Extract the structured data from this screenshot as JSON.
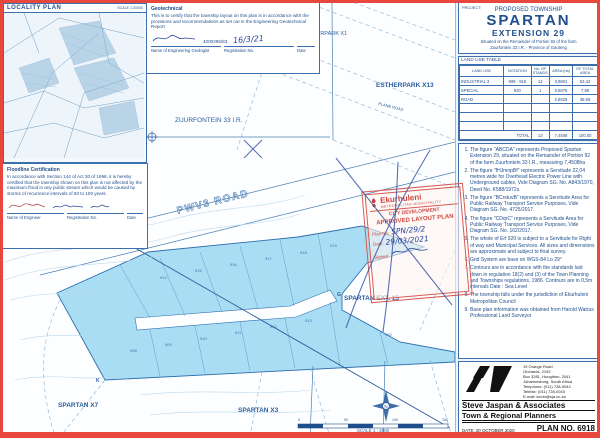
{
  "locality": {
    "title": "LOCALITY PLAN",
    "scale": "SCALE 1:20000"
  },
  "geotechnical": {
    "title": "Geotechnical",
    "body": "This is to certify that the township layout on this plan is in accordance with the provisions and recommendations as set out in the Engineering Geotechnical Report",
    "registration_no": "4000295/83",
    "date_handwritten": "16/3/21",
    "labels": {
      "name": "Name of Engineering Geologist",
      "registration": "Registration No.",
      "date": "Date"
    }
  },
  "floodline": {
    "title": "Floodline Certification",
    "body": "In accordance with Section 144 of Act 30 of 1998, it is hereby certified that the township shown on this plan is not affected by the maximum flood in any public stream which would be caused by storms of recurrence intervals of 50 to 100 years.",
    "labels": {
      "name": "Name of Engineer",
      "registration": "Registration No.",
      "date": "Date"
    }
  },
  "map": {
    "labels": {
      "estherpark_x1": "ESTHERPARK X1",
      "estherpark_x13": "ESTHERPARK X13",
      "zuurfontein": "ZUURFONTEIN 33 I.R.",
      "pwv3": "PWV3 ROAD",
      "plane_road": "PLANE ROAD",
      "spartan_ext15": "SPARTAN EXT. 15",
      "spartan_x7": "SPARTAN X7",
      "spartan_x3": "SPARTAN X3",
      "point_g": "G",
      "point_k": "K",
      "scale": "SCALE 1 : 2000",
      "scale_ticks": [
        "0",
        "50",
        "100",
        "150"
      ]
    },
    "stands": [
      "908",
      "909",
      "910",
      "911",
      "912",
      "913",
      "914",
      "915",
      "916",
      "917",
      "918",
      "919",
      "920"
    ]
  },
  "stamp": {
    "municipality": "Ekurhuleni",
    "subtitle": "METROPOLITAN MUNICIPALITY",
    "dept": "CITY DEVELOPMENT",
    "approved": "APPROVED LAYOUT PLAN",
    "plan_no_label": "Plan No:",
    "plan_no_value": "SPN/29/2",
    "date_label": "Date:",
    "date_value": "29/03/2021",
    "signed_label": "Signed"
  },
  "title_block": {
    "project_label": "PROJECT:",
    "line1": "PROPOSED TOWNSHIP",
    "name": "SPARTAN",
    "extension": "EXTENSION 29",
    "subtitle1": "Situated on the Remainder of Portion 92 of the farm",
    "subtitle2": "Zuurfontein 33 I.R.  -  Province of Gauteng"
  },
  "land_use_table": {
    "title": "LAND USE TABLE",
    "headers": [
      "LAND USE",
      "NOTATION",
      "No. OF STANDS",
      "AREA [ha]",
      "OF TOTAL AREA"
    ],
    "rows": [
      {
        "land_use": "INDUSTRIAL 3",
        "notation": "908 - 919",
        "stands": "12",
        "area": "3,9801",
        "pct": "53,42"
      },
      {
        "land_use": "SPECIAL",
        "notation": "920",
        "stands": "1",
        "area": "0,5878",
        "pct": "7,89"
      },
      {
        "land_use": "ROAD",
        "notation": "",
        "stands": "",
        "area": "2,8829",
        "pct": "38,69"
      }
    ],
    "total_label": "TOTAL",
    "total": {
      "stands": "13",
      "area": "7,4508",
      "pct": "100,00"
    }
  },
  "notes": [
    "The figure \"ABCDA\" represents Proposed Spartan Extension 29, situated on the Remainder of Portion 92 of the farm Zuurfontein 33 I.R., measuring 7,4508ha",
    "The figure \"fHJmnpBf\" represents a Servitude 22,04 metres wide for Overhead Electric Power Line with Underground cables, Vide Diagram SG. No. A843/1970, Deed No. K588/1972s.",
    "The figure \"BCrstuvB\" represents a Servitude Area for Public Railway Transport Service Purposes, Vide Diagram SG. No. 4725/2017.",
    "The figure \"CDqrC\" represents a Servitude Area for Public Railway Transport Service Purposes, Vide Diagram SG. No. 162/2017.",
    "The whole of Erf 920 is subject to a Servitude for Right of way and Municipal Services. All sizes and dimensions are approximate and subject to final survey.",
    "Grid System are base on WGS-84 Lo 29°",
    "Contours are in accordance with the standards laid down in regulation 18(2) and (3) of the Town Planning and Townships regulations, 1986. Contours are in 0,5m intervals Date : Sea Level",
    "The township falls under the jurisdiction of Ekurhuleni Metropolitan Council",
    "Base plan information was obtained from Harold Watrus Professional Land Surveyor"
  ],
  "firm": {
    "name": "Steve Jaspan & Associates",
    "title": "Town & Regional Planners",
    "address": [
      "19 Orange Road",
      "Orchards, 2192",
      "Box 3281, Houghton, 2041",
      "Johannesburg, South Africa",
      "Telephone: (011) 728-0042",
      "Telefax: (011) 728-0043",
      "E-mail: kevin@sja.co.za"
    ],
    "date_label": "DATE:",
    "date_value": "20 OCTOBER 2020",
    "plan_no": "PLAN NO. 6918"
  }
}
